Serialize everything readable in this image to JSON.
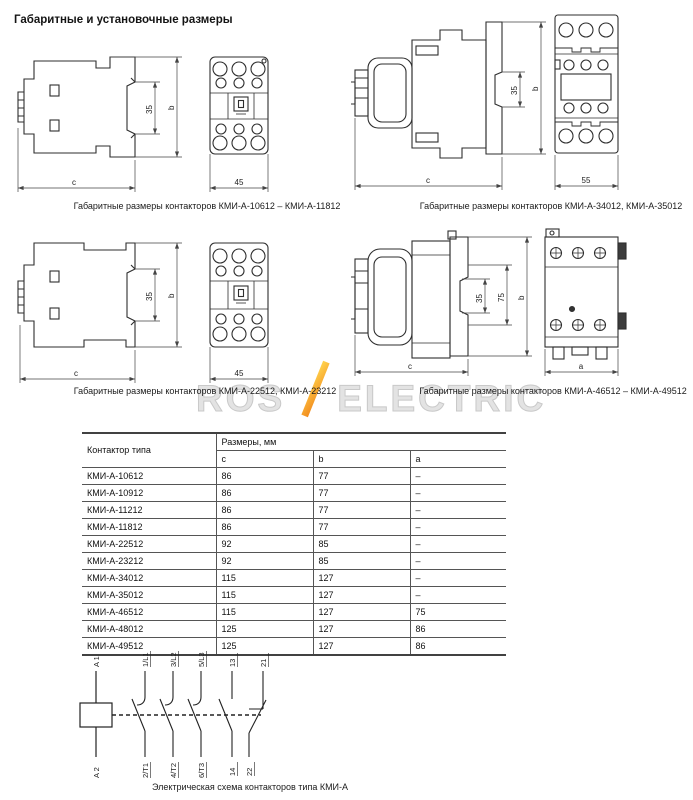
{
  "page": {
    "title": "Габаритные и установочные размеры"
  },
  "watermark": {
    "left": "ROS",
    "right": "ELECTRIC",
    "slash_color": "#f28c1e",
    "text_color": "#e3e3e3"
  },
  "drawings": [
    {
      "caption": "Габаритные размеры контакторов КМИ-А-10612 – КМИ-А-11812",
      "dims": {
        "rail": "35",
        "height": "b",
        "depth": "c",
        "width": "45"
      }
    },
    {
      "caption": "Габаритные размеры контакторов КМИ-А-34012, КМИ-А-35012",
      "dims": {
        "rail": "35",
        "height": "b",
        "depth": "c",
        "width": "55"
      }
    },
    {
      "caption": "Габаритные размеры контакторов КМИ-А-22512, КМИ-А-23212",
      "dims": {
        "rail": "35",
        "height": "b",
        "depth": "c",
        "width": "45"
      }
    },
    {
      "caption": "Габаритные размеры контакторов КМИ-А-46512 – КМИ-А-49512",
      "dims": {
        "rail": "35",
        "holes": "75",
        "height": "b",
        "depth": "c",
        "width": "a"
      }
    }
  ],
  "table": {
    "type_header": "Контактор типа",
    "group_header": "Размеры, мм",
    "columns": [
      "c",
      "b",
      "a"
    ],
    "rows": [
      {
        "type": "КМИ-А-10612",
        "c": "86",
        "b": "77",
        "a": "–"
      },
      {
        "type": "КМИ-А-10912",
        "c": "86",
        "b": "77",
        "a": "–"
      },
      {
        "type": "КМИ-А-11212",
        "c": "86",
        "b": "77",
        "a": "–"
      },
      {
        "type": "КМИ-А-11812",
        "c": "86",
        "b": "77",
        "a": "–"
      },
      {
        "type": "КМИ-А-22512",
        "c": "92",
        "b": "85",
        "a": "–"
      },
      {
        "type": "КМИ-А-23212",
        "c": "92",
        "b": "85",
        "a": "–"
      },
      {
        "type": "КМИ-А-34012",
        "c": "115",
        "b": "127",
        "a": "–"
      },
      {
        "type": "КМИ-А-35012",
        "c": "115",
        "b": "127",
        "a": "–"
      },
      {
        "type": "КМИ-А-46512",
        "c": "115",
        "b": "127",
        "a": "75"
      },
      {
        "type": "КМИ-А-48012",
        "c": "125",
        "b": "127",
        "a": "86"
      },
      {
        "type": "КМИ-А-49512",
        "c": "125",
        "b": "127",
        "a": "86"
      }
    ]
  },
  "schematic": {
    "caption": "Электрическая схема контакторов типа КМИ-А",
    "coil_top": "A 1",
    "coil_bottom": "A 2",
    "poles_top": [
      "1/L1",
      "3/L2",
      "5/L3"
    ],
    "poles_bottom": [
      "2/Т1",
      "4/Т2",
      "6/Т3"
    ],
    "aux_no_top": "13",
    "aux_no_bottom": "14",
    "aux_nc_top": "21",
    "aux_nc_bottom": "22"
  }
}
